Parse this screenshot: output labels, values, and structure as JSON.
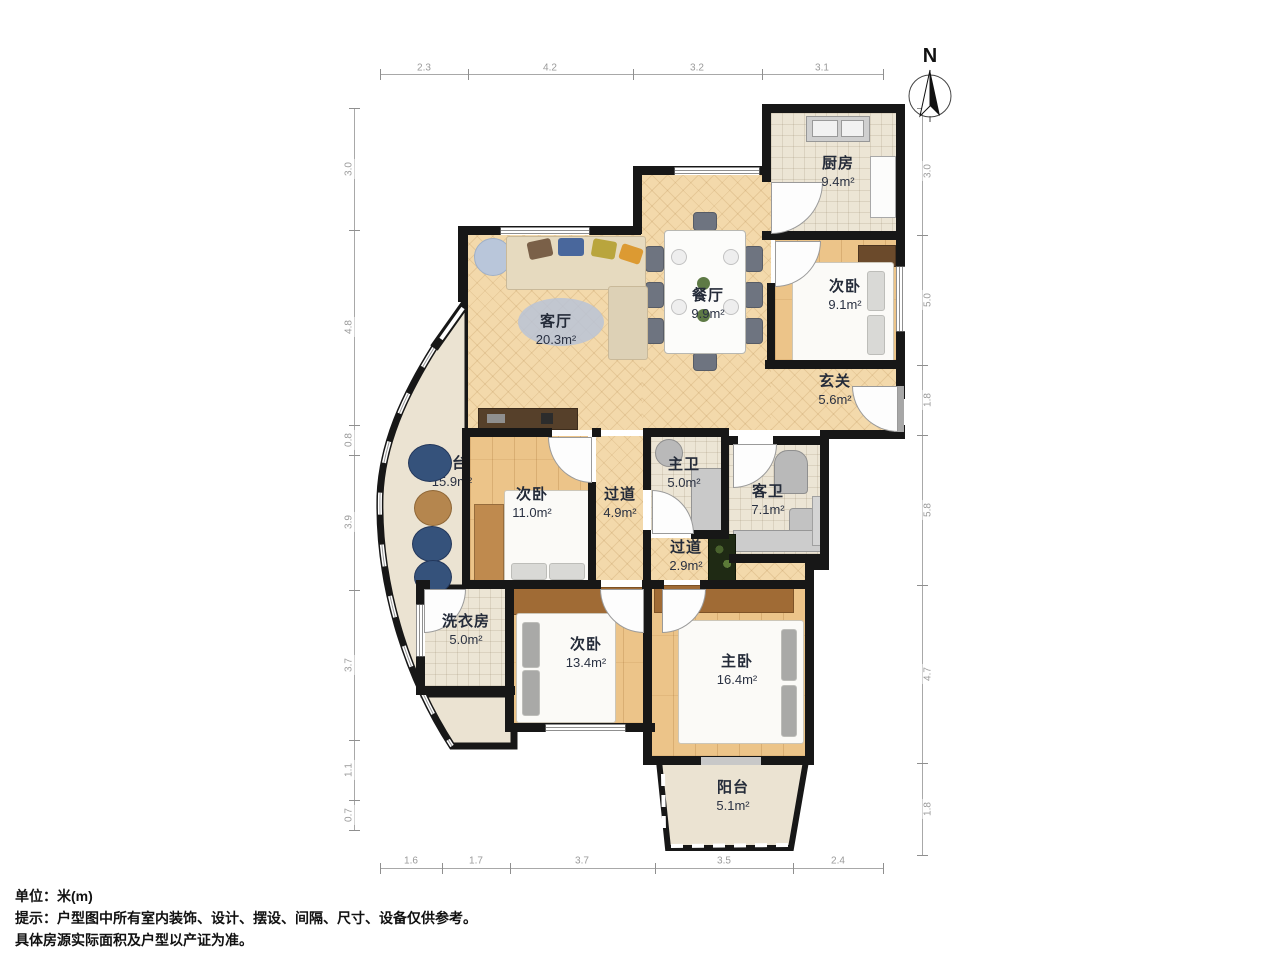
{
  "rooms": {
    "kitchen": {
      "name": "厨房",
      "area": "9.4m²"
    },
    "bedroom2": {
      "name": "次卧",
      "area": "9.1m²"
    },
    "foyer": {
      "name": "玄关",
      "area": "5.6m²"
    },
    "dining": {
      "name": "餐厅",
      "area": "9.9m²"
    },
    "living": {
      "name": "客厅",
      "area": "20.3m²"
    },
    "terrace": {
      "name": "露台",
      "area": "15.9m²"
    },
    "bedroom3": {
      "name": "次卧",
      "area": "11.0m²"
    },
    "hallway1": {
      "name": "过道",
      "area": "4.9m²"
    },
    "master_bath": {
      "name": "主卫",
      "area": "5.0m²"
    },
    "guest_bath": {
      "name": "客卫",
      "area": "7.1m²"
    },
    "hallway2": {
      "name": "过道",
      "area": "2.9m²"
    },
    "laundry": {
      "name": "洗衣房",
      "area": "5.0m²"
    },
    "bedroom4": {
      "name": "次卧",
      "area": "13.4m²"
    },
    "master_bedroom": {
      "name": "主卧",
      "area": "16.4m²"
    },
    "balcony": {
      "name": "阳台",
      "area": "5.1m²"
    }
  },
  "dimensions": {
    "top": [
      "2.3",
      "4.2",
      "3.2",
      "3.1"
    ],
    "bottom": [
      "1.6",
      "1.7",
      "3.7",
      "3.5",
      "2.4"
    ],
    "left": [
      "3.0",
      "4.8",
      "0.8",
      "3.9",
      "3.7",
      "1.1",
      "0.7"
    ],
    "right": [
      "3.0",
      "5.0",
      "1.8",
      "5.8",
      "4.7",
      "1.8"
    ]
  },
  "compass": {
    "label": "N"
  },
  "footer": {
    "unit": "单位：米(m)",
    "notice1": "提示：户型图中所有室内装饰、设计、摆设、间隔、尺寸、设备仅供参考。",
    "notice2": "具体房源实际面积及户型以产证为准。"
  },
  "colors": {
    "wall": "#171717",
    "wood_floor": "#ecc489",
    "herringbone_floor": "#f3d9ab",
    "tile_floor": "#ece5d5",
    "dimension_text": "#9a9a9a",
    "label_text": "#242b39"
  }
}
